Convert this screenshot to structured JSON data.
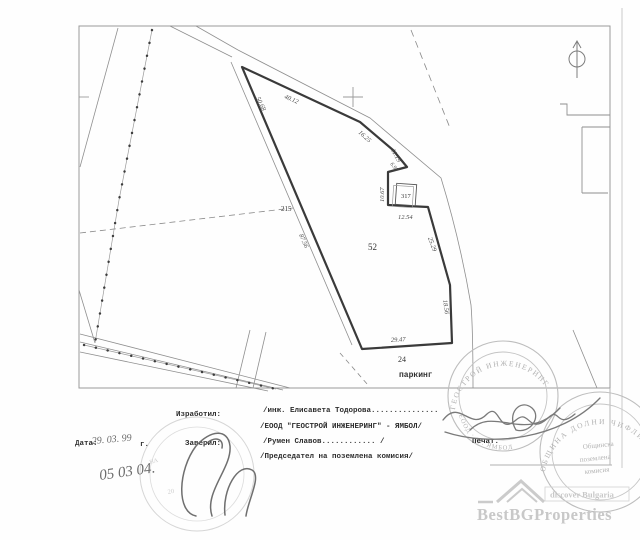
{
  "map": {
    "dimensions": [
      "50.68",
      "40.12",
      "16.25",
      "11.19",
      "6.98",
      "10.67",
      "12.54",
      "25.29",
      "18.56",
      "29.47",
      "87.56"
    ],
    "labels": {
      "plot_number": "52",
      "parking_number": "24",
      "parking_label": "паркинг",
      "building_number": "317",
      "road_number": "215"
    }
  },
  "footer": {
    "made_by_label": "Изработил:",
    "made_by_value": "/инж. Елисавета Тодорова...............",
    "company_line": "/ЕООД \"ГЕОСТРОЙ ИНЖЕНЕРИНГ\" - ЯМБОЛ/",
    "date_label": "Дата:",
    "date_handwritten": "29. 03. 99",
    "date_suffix": "г.",
    "certified_label": "Заверил:",
    "certified_value": "/Румен Славов............ /",
    "chairman_line": "/Председател на поземлена комисия/",
    "stamp_label": "Печат.",
    "date_handwritten2": "05 03 04."
  },
  "stamps": {
    "geostroy_top": "ГЕОСТРОЙ ИНЖЕНЕРИНГ",
    "geostroy_bottom": "ЕООД · гр. ЯМБОЛ",
    "municipality_arc": "ОБЩИНА ДОЛНИ ЧИФЛИК",
    "municipality_line1": "Общинска",
    "municipality_line2": "поземлена",
    "municipality_line3": "комисия",
    "faint_fragment1": "НА",
    "faint_fragment2": "20"
  },
  "watermark": {
    "brand": "BestBGProperties",
    "tagline": "discover Bulgaria"
  }
}
